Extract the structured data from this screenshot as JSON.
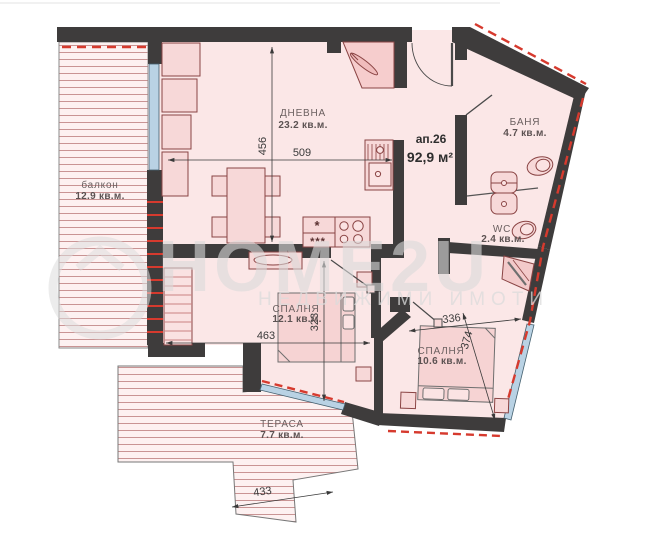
{
  "unit": {
    "number": "ап.26",
    "area": "92,9 м²"
  },
  "rooms": {
    "living": {
      "name": "ДНЕВНА",
      "area": "23.2 кв.м."
    },
    "balcony": {
      "name": "балкон",
      "area": "12.9 кв.м."
    },
    "bath": {
      "name": "БАНЯ",
      "area": "4.7 кв.м."
    },
    "wc": {
      "name": "WC",
      "area": "2.4 кв.м."
    },
    "bedroom1": {
      "name": "СПАЛНЯ",
      "area": "12.1 кв.м."
    },
    "bedroom2": {
      "name": "СПАЛНЯ",
      "area": "10.6 кв.м."
    },
    "terrace": {
      "name": "ТЕРАСА",
      "area": "7.7 кв.м."
    }
  },
  "dimensions": {
    "living_width": "509",
    "living_height": "456",
    "bedroom1_width": "463",
    "bedroom1_height": "323",
    "bedroom2_width": "336",
    "bedroom2_height": "374",
    "terrace_width": "433"
  },
  "kitchen": {
    "fridge_star": "*",
    "freezer_stars": "***"
  },
  "watermark": {
    "brand": "HOME2U",
    "tagline": "НЕДВИЖИМИ ИМОТИ"
  },
  "colors": {
    "wall": "#3e3c3c",
    "room_fill": "#fbe7e7",
    "outdoor_fill": "#fdf1f1",
    "hatch_line": "#c99494",
    "window_glass": "#b9d2e4",
    "insulation_dash_red": "#d63a2e",
    "furniture_stroke": "#8a4444",
    "furniture_fill": "#f7d8d8"
  }
}
